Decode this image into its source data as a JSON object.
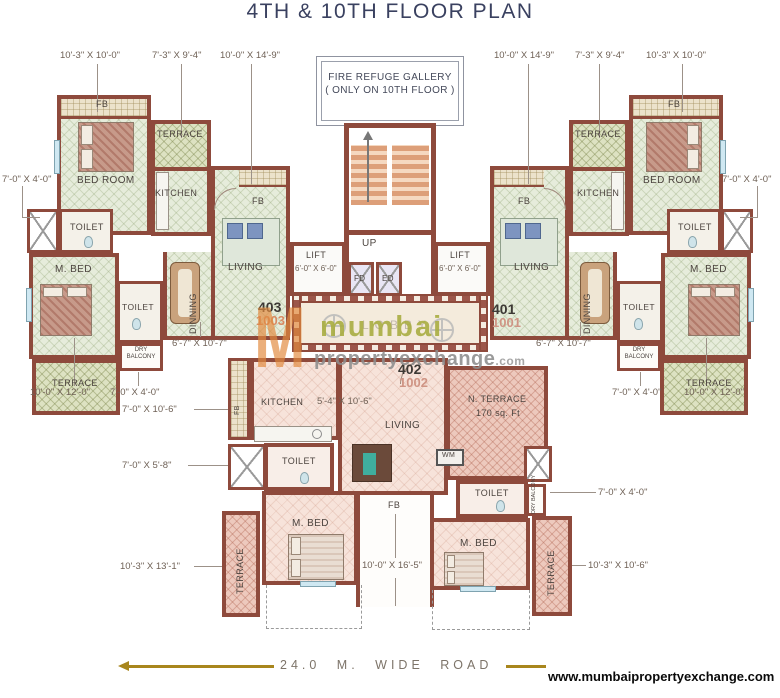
{
  "title": "4TH & 10TH FLOOR PLAN",
  "fire_refuge": {
    "line1": "FIRE REFUGE GALLERY",
    "line2": "( ONLY ON 10TH FLOOR )"
  },
  "labels": {
    "fb": "FB",
    "bed_room": "BED ROOM",
    "terrace": "TERRACE",
    "kitchen": "KITCHEN",
    "toilet": "TOILET",
    "m_bed": "M. BED",
    "dinning": "DINNING",
    "living": "LIVING",
    "dry_balcony": "DRY BALCONY",
    "n_terrace": "N. TERRACE",
    "n_terrace_area": "170 sq. Ft",
    "wm": "WM",
    "lobby": "LOBBY",
    "lift": "LIFT",
    "up": "UP",
    "fd": "FD",
    "ed": "ED"
  },
  "dims": {
    "bedroom": "10'-3\" X 10'-0\"",
    "terrace_kitchen": "7'-3\" X 9'-4\"",
    "living": "10'-0\" X 14'-9\"",
    "toilet": "7'-0\" X 4'-0\"",
    "dinning": "6'-7\" X 10'-7\"",
    "wing_terrace": "10'-0\" X 12'-0\"",
    "dry_balcony": "7'-0\" X 4'-0\"",
    "c_kitchen_side": "7'-0\" X 10'-6\"",
    "c_toilet": "7'-0\" X 5'-8\"",
    "c_terrace_left": "10'-3\" X 13'-1\"",
    "c_kitchen": "5'-4\" X 10'-6\"",
    "c_fb": "10'-0\" X 16'-5\"",
    "c_terrace_right": "10'-3\" X 10'-6\"",
    "lift": "6'-0\" X 6'-0\""
  },
  "flats": {
    "left_no": "403",
    "left_alt": "1003",
    "right_no": "401",
    "right_alt": "1001",
    "center_no": "402",
    "center_alt": "1002"
  },
  "watermark": {
    "monogram": "M",
    "brand": "mumbai",
    "brand2": "propertyexchange",
    "tld": ".com"
  },
  "footer": {
    "road": "24.0 M.  WIDE ROAD",
    "website": "www.mumbaipropertyexchange.com"
  },
  "colors": {
    "wall": "#8e4a3c",
    "title_text": "#3a4160",
    "floor_green": "#e6ecdb",
    "floor_olive": "#dde2c2",
    "floor_pink": "#f7e3da",
    "terrace_pink": "#edc9bd",
    "brand_orange": "#e28a3e",
    "brand_olive": "#a9ae42",
    "road_gold": "#a8861d"
  }
}
